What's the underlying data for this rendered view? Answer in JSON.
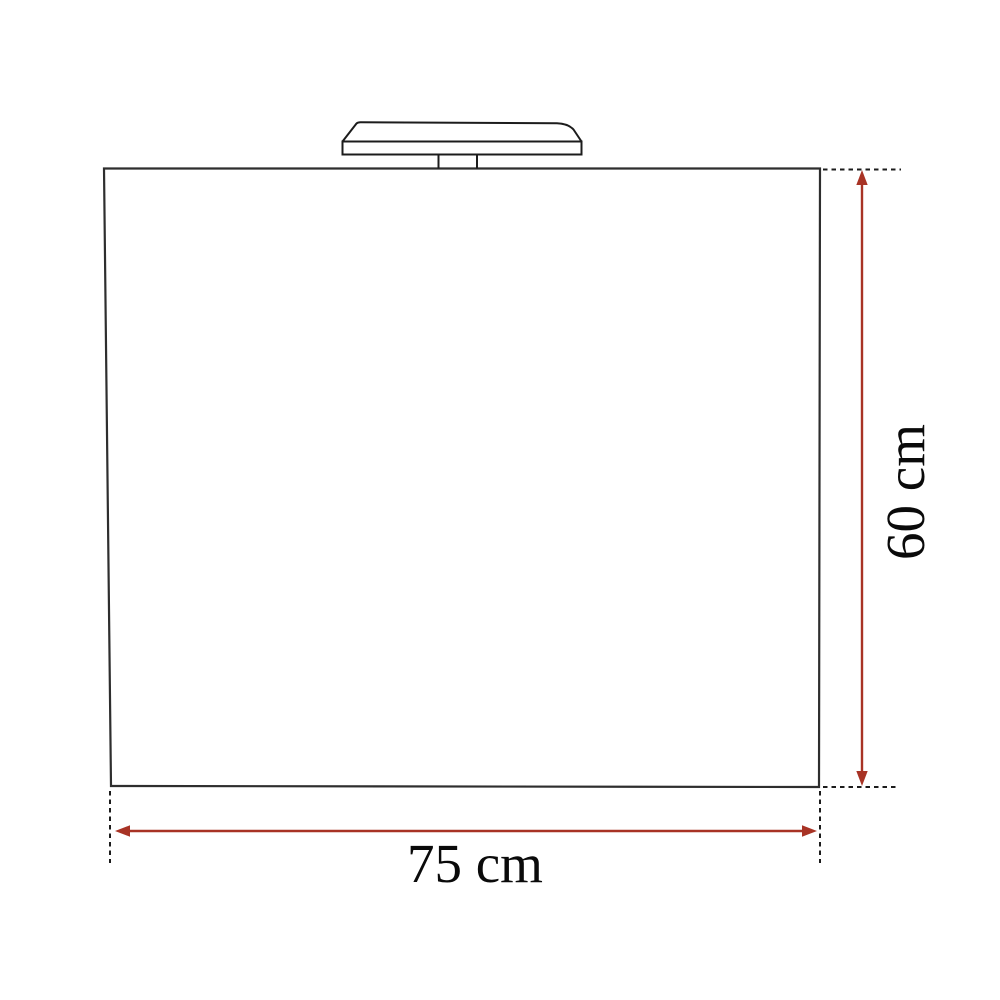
{
  "diagram": {
    "type": "dimension-diagram",
    "labels": {
      "width": "75 cm",
      "height": "60 cm"
    },
    "dimensions": {
      "width_cm": 75,
      "height_cm": 60,
      "unit": "cm"
    },
    "colors": {
      "outline": "#2e2e2e",
      "lamp_outline": "#1c1c1c",
      "extension_line": "#1c1c1c",
      "arrow": "#a83325",
      "fill": "#ffffff",
      "text": "#0a0a0a"
    }
  }
}
